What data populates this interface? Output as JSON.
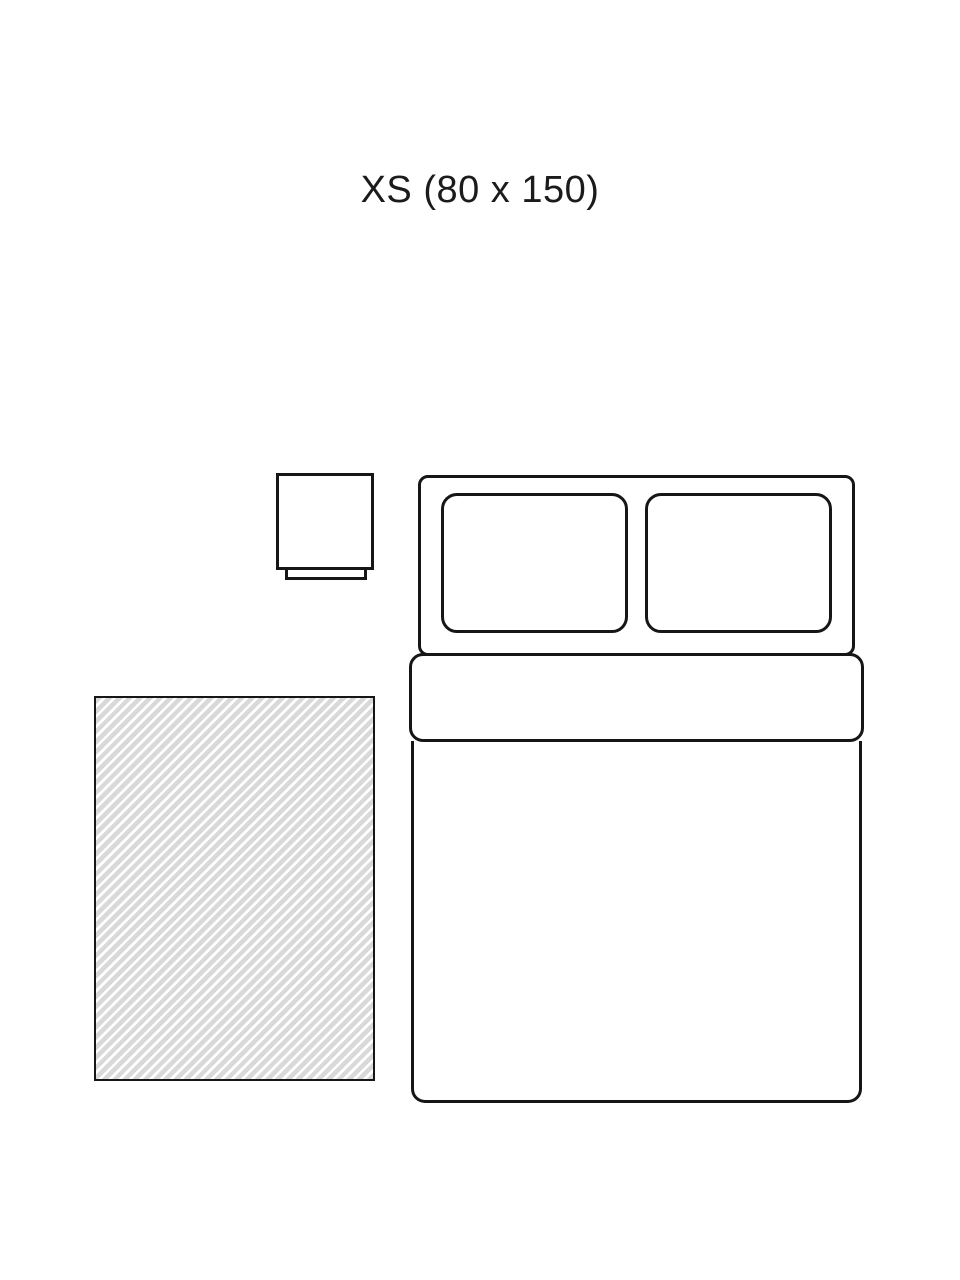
{
  "title": {
    "text": "XS (80 x 150)",
    "size_code": "XS",
    "dimensions_cm": "80 x 150"
  },
  "colors": {
    "background": "#ffffff",
    "line": "#161616",
    "rug_hatch": "#d9d9d9",
    "rug_hatch_alt": "#ffffff"
  },
  "diagram": {
    "description_items": {
      "rug": "hatched rectangle (rug, size XS 80 x 150)",
      "bed": "double bed seen from above with two pillows and folded duvet",
      "nightstand": "bedside table beside the headboard"
    },
    "pillow_count": 2
  }
}
